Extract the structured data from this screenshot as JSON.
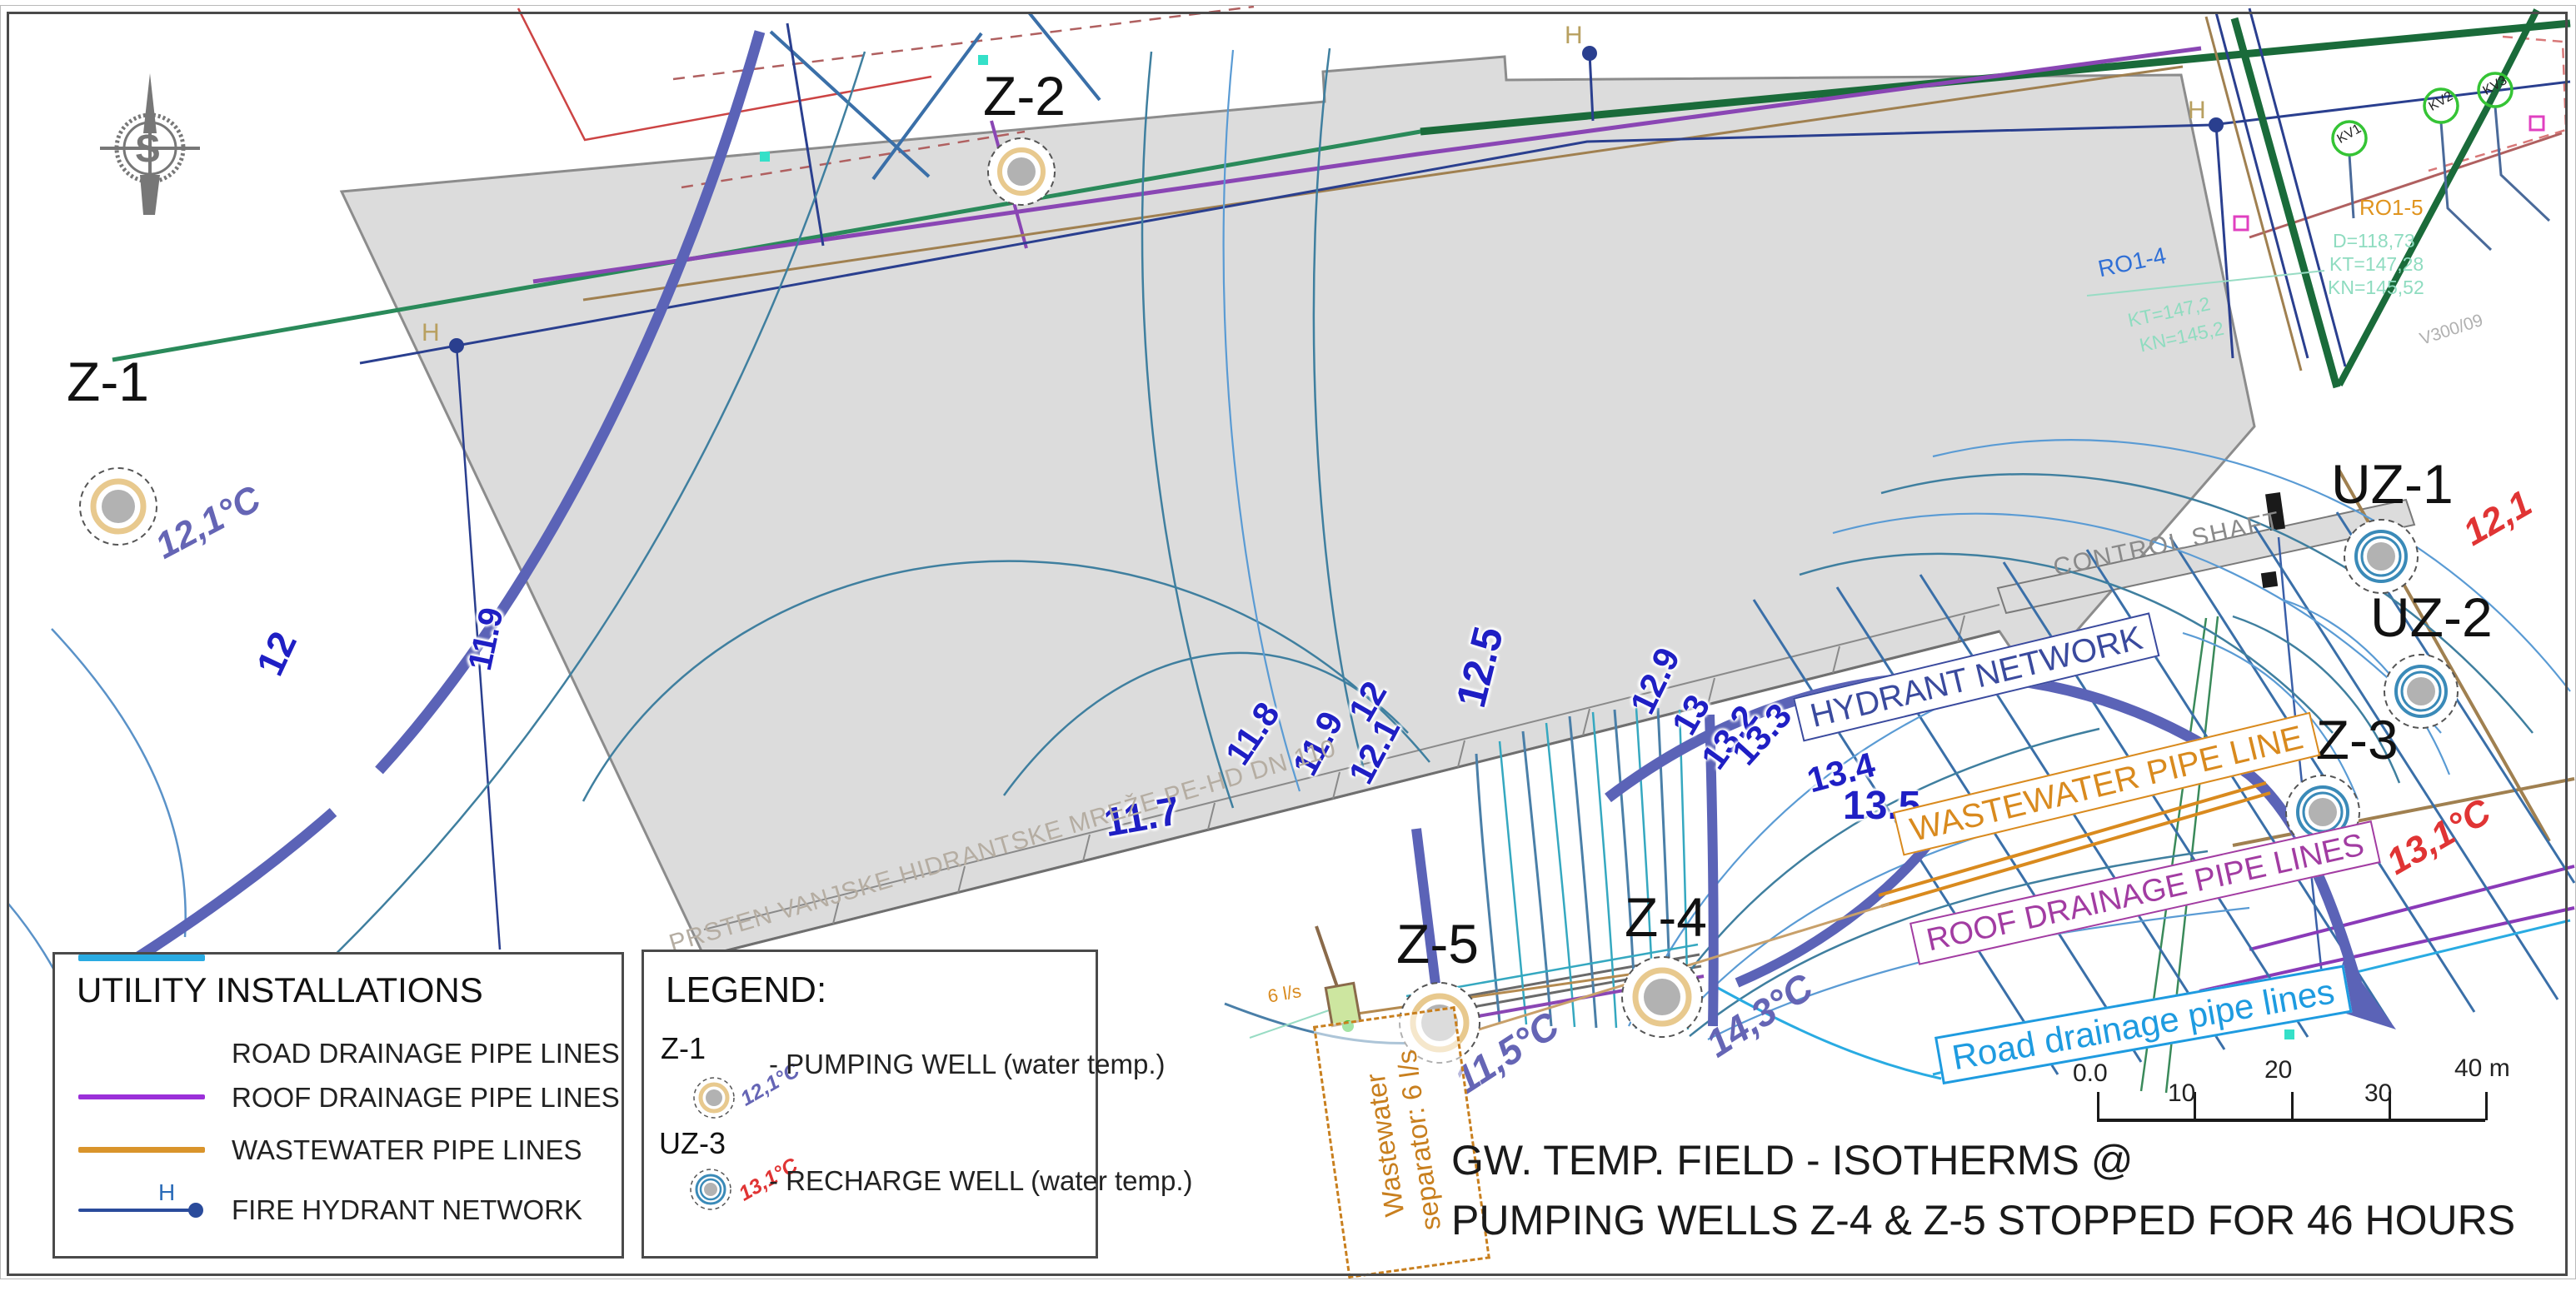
{
  "title": {
    "line1": "GW. TEMP. FIELD - ISOTHERMS @",
    "line2": "PUMPING WELLS Z-4 & Z-5 STOPPED FOR 46 HOURS"
  },
  "compass": {
    "letter": "S"
  },
  "wells": [
    {
      "id": "Z-1",
      "type": "pumping",
      "temp": "12,1°C"
    },
    {
      "id": "Z-2",
      "type": "pumping",
      "temp": ""
    },
    {
      "id": "Z-5",
      "type": "pumping",
      "temp": "11,5°C"
    },
    {
      "id": "Z-4",
      "type": "pumping",
      "temp": "14,3°C"
    },
    {
      "id": "UZ-1",
      "type": "recharge",
      "temp": "12,1"
    },
    {
      "id": "UZ-2",
      "type": "recharge",
      "temp": ""
    },
    {
      "id": "UZ-3",
      "type": "recharge",
      "temp": "13,1°C"
    }
  ],
  "isotherms": {
    "labels": [
      {
        "v": "12"
      },
      {
        "v": "11.9"
      },
      {
        "v": "11.7"
      },
      {
        "v": "11.8"
      },
      {
        "v": "11.9"
      },
      {
        "v": "12"
      },
      {
        "v": "12.1"
      },
      {
        "v": "12.5"
      },
      {
        "v": "12.9"
      },
      {
        "v": "13"
      },
      {
        "v": "13.2"
      },
      {
        "v": "13.3"
      },
      {
        "v": "13.4"
      },
      {
        "v": "13.5"
      }
    ]
  },
  "pipe_labels": {
    "hydrant": "HYDRANT NETWORK",
    "wastewater": "WASTEWATER PIPE LINE",
    "roof": "ROOF DRAINAGE PIPE LINES",
    "road": "Road drainage pipe lines"
  },
  "site_texts": {
    "control_shaft": "CONTROL SHAFT",
    "hydrant_ring": "PRSTEN VANJSKE HIDRANTSKE MREŽE PE-HD DN 110",
    "separator_line1": "Wastewater",
    "separator_line2": "separator: 6 l/s",
    "separator_flow": "6 l/s",
    "hydrant_h": "H",
    "ro15": {
      "name": "RO1-5",
      "d": "D=118,73",
      "kt": "KT=147,28",
      "kn": "KN=145,52"
    },
    "ro14": {
      "name": "RO1-4",
      "kt": "KT=147,2",
      "kn": "KN=145,2"
    },
    "kv_markers": [
      "KV1",
      "KV2",
      "KV3"
    ],
    "v_ref": "V300/09"
  },
  "utility_legend": {
    "title": "UTILITY INSTALLATIONS",
    "items": [
      {
        "label": "ROAD DRAINAGE PIPE LINES",
        "color": "#29abe2"
      },
      {
        "label": "ROOF DRAINAGE PIPE LINES",
        "color": "#9b30d9"
      },
      {
        "label": "WASTEWATER  PIPE LINES",
        "color": "#d9942b"
      },
      {
        "label": "FIRE HYDRANT NETWORK",
        "color": "#2a4b9b",
        "h": "H"
      }
    ]
  },
  "legend_box": {
    "title": "LEGEND:",
    "entries": [
      {
        "well": "Z-1",
        "temp": "12,1°C",
        "desc": "- PUMPING WELL (water temp.)"
      },
      {
        "well": "UZ-3",
        "temp": "13,1°C",
        "desc": "- RECHARGE WELL (water temp.)"
      }
    ]
  },
  "scale_bar": {
    "ticks": [
      "0.0",
      "10",
      "20",
      "30",
      "40 m"
    ]
  },
  "colors": {
    "road_drainage": "#29abe2",
    "roof_drainage": "#9b30d9",
    "wastewater": "#d9942b",
    "fire_hydrant": "#2a4b9b",
    "isotherm_thick": "#5b63b7",
    "isotherm_thin": "#3f7f9f",
    "isotherm_label": "#1f1fc4",
    "pumping_temp": "#6565b5",
    "recharge_temp": "#e03434",
    "building_fill": "#dcdcdc"
  }
}
